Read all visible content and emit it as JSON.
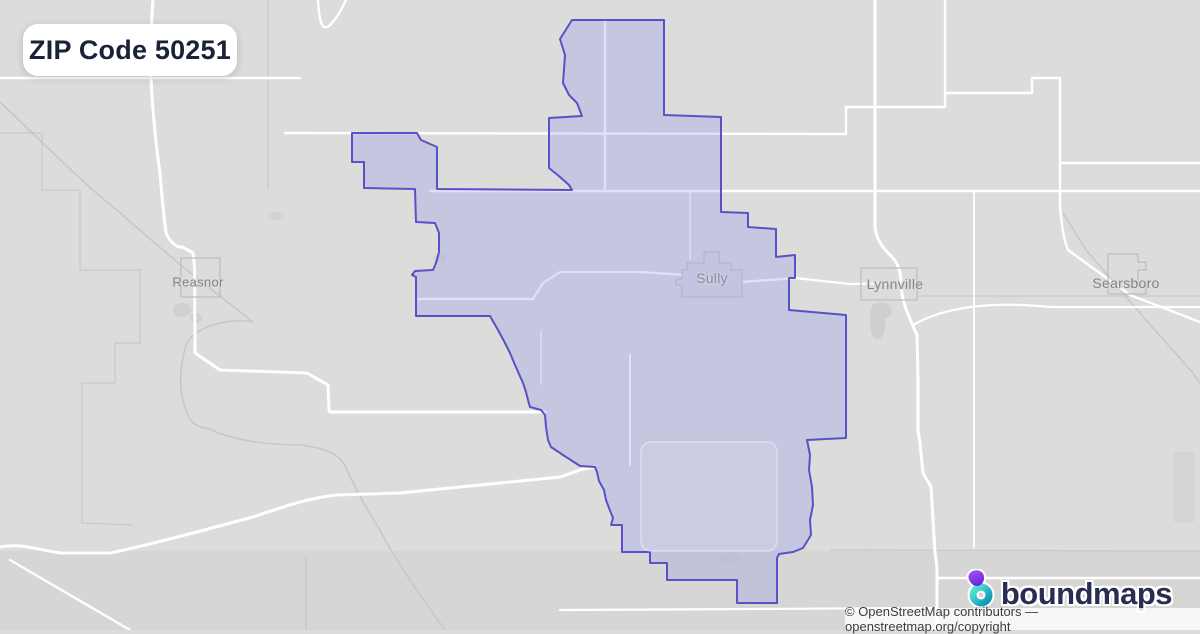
{
  "badge": {
    "title": "ZIP Code 50251"
  },
  "map": {
    "towns": [
      {
        "name": "Reasnor"
      },
      {
        "name": "Sully"
      },
      {
        "name": "Lynnville"
      },
      {
        "name": "Searsboro"
      }
    ]
  },
  "branding": {
    "logo_text": "boundmaps"
  },
  "attribution": {
    "text": "© OpenStreetMap contributors — openstreetmap.org/copyright"
  },
  "colors": {
    "map_background": "#dcdcdb",
    "road": "#ffffff",
    "railway": "#c8c8c8",
    "zip_boundary_stroke": "#5b50c8",
    "zip_boundary_fill": "rgba(140,148,238,0.28)",
    "badge_text": "#1a2238",
    "logo_text": "#272e52",
    "logo_purple": "#8b5cf6",
    "logo_teal": "#22d3ee",
    "town_label": "#84848c"
  }
}
